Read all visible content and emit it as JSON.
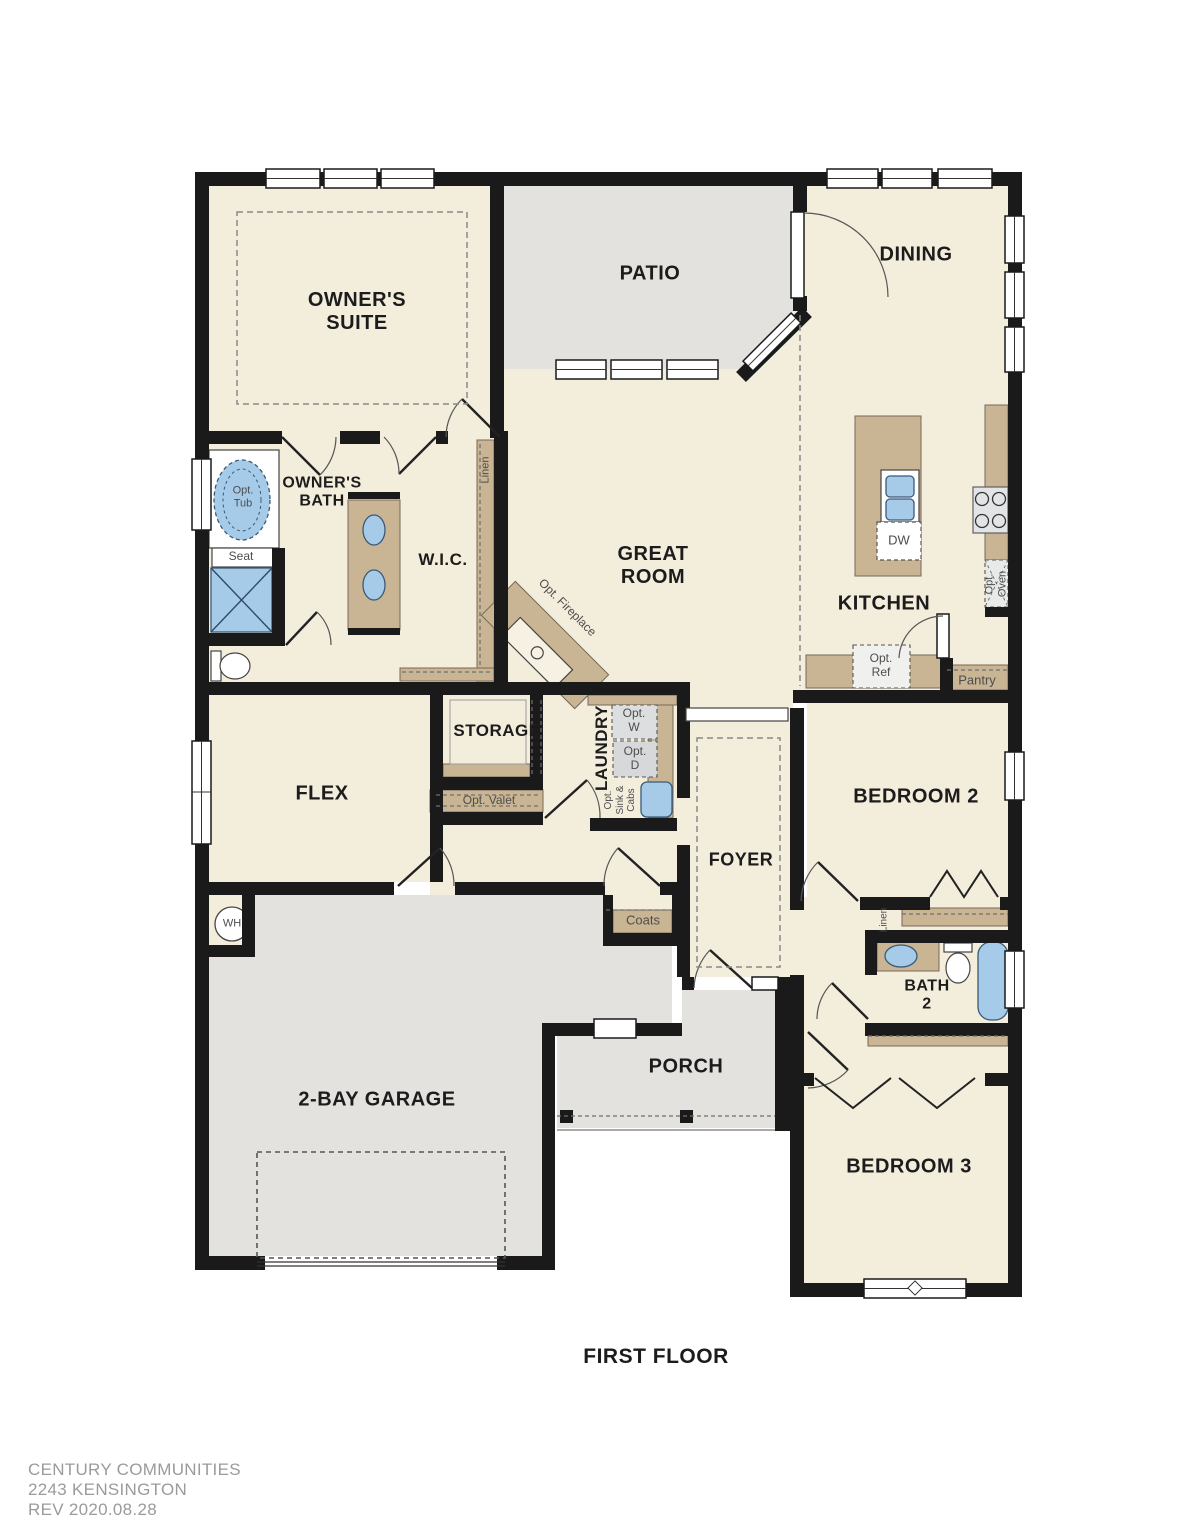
{
  "title": "FIRST FLOOR",
  "footer": {
    "line1": "CENTURY COMMUNITIES",
    "line2": "2243 KENSINGTON",
    "line3": "REV 2020.08.28"
  },
  "rooms": {
    "owners_suite": "OWNER'S\nSUITE",
    "patio": "PATIO",
    "dining": "DINING",
    "owners_bath": "OWNER'S\nBATH",
    "wic": "W.I.C.",
    "great_room": "GREAT\nROOM",
    "kitchen": "KITCHEN",
    "flex": "FLEX",
    "storage": "STORAGE",
    "laundry": "LAUNDRY",
    "foyer": "FOYER",
    "bedroom2": "BEDROOM 2",
    "bath2": "BATH\n2",
    "bedroom3": "BEDROOM 3",
    "garage": "2-BAY GARAGE",
    "porch": "PORCH"
  },
  "fixtures": {
    "opt_tub": "Opt.\nTub",
    "seat": "Seat",
    "linen_wic": "Linen",
    "opt_fireplace": "Opt. Fireplace",
    "dw": "DW",
    "opt_oven": "Opt.\nOven",
    "opt_ref": "Opt.\nRef",
    "pantry": "Pantry",
    "opt_valet": "Opt. Valet",
    "opt_w": "Opt.\nW",
    "opt_d": "Opt.\nD",
    "opt_sink_cabs": "Opt.\nSink &\nCabs",
    "coats": "Coats",
    "wh": "WH",
    "linen_hall": "Linen"
  },
  "colors": {
    "wall": "#1a1a1a",
    "floor": "#f3eddc",
    "exterior_concrete": "#e4e2de",
    "cabinet": "#c9b593",
    "fixture_blue": "#a5cbe9",
    "appliance": "#e2e4e5"
  }
}
